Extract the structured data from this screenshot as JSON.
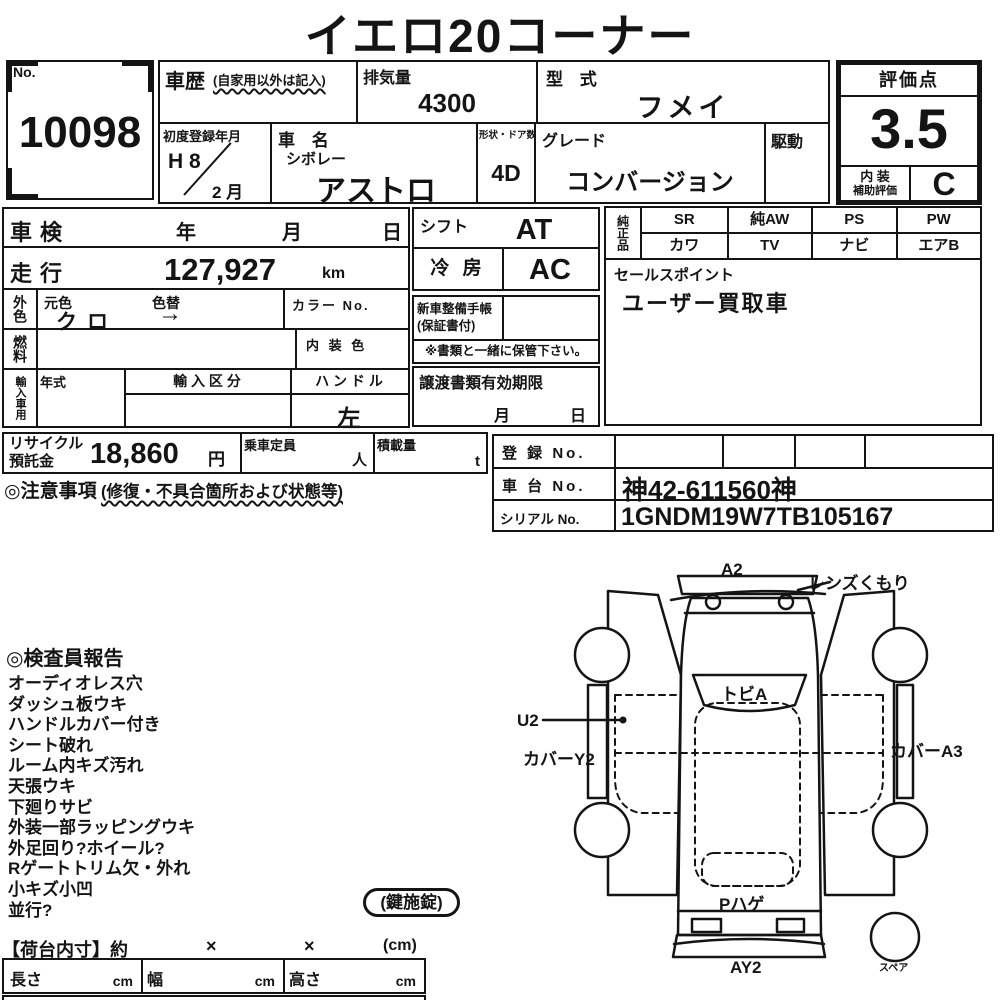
{
  "title": "イエロ20コーナー",
  "header": {
    "no_label": "No.",
    "no_value": "10098",
    "history_label": "車歴",
    "history_note": "(自家用以外は記入)",
    "displacement_label": "排気量",
    "displacement_value": "4300",
    "model_code_label": "型 式",
    "model_code_value": "フメイ",
    "first_reg_label": "初度登録年月",
    "first_reg_year": "H 8",
    "first_reg_month": "2 月",
    "car_name_label": "車 名",
    "car_maker": "シボレー",
    "car_model": "アストロ",
    "shape_doors_label": "形状・ドア数",
    "shape_doors_value": "4D",
    "grade_label": "グレード",
    "grade_value": "コンバージョン",
    "drive_label": "駆動",
    "score_label": "評価点",
    "score_value": "3.5",
    "interior_label_line1": "内 装",
    "interior_label_line2": "補助評価",
    "interior_grade": "C"
  },
  "inspection": {
    "shaken_label": "車検",
    "year": "年",
    "month": "月",
    "day": "日",
    "mileage_label": "走行",
    "mileage_value": "127,927",
    "mileage_unit": "km",
    "ext_color_label": "外色",
    "orig_color_label": "元色",
    "orig_color_value": "クロ",
    "color_change_label": "色替",
    "color_change_value": "→",
    "color_no_label": "カラー No.",
    "fuel_label": "燃料",
    "interior_color_label": "内 装 色",
    "import_label": "輸入車用",
    "year_model_label": "年式",
    "import_class_label": "輸 入 区 分",
    "handle_label": "ハ ン ド ル",
    "handle_value": "左",
    "shift_label": "シフト",
    "shift_value": "AT",
    "ac_label": "冷 房",
    "ac_value": "AC",
    "service_book_line1": "新車整備手帳",
    "service_book_line2": "(保証書付)",
    "service_note": "※書類と一緒に保管下さい。",
    "transfer_label": "譲渡書類有効期限",
    "transfer_month": "月",
    "transfer_day": "日",
    "oem_label": "純正品",
    "oem_grid": [
      [
        "SR",
        "カワ"
      ],
      [
        "純AW",
        "TV"
      ],
      [
        "PS",
        "ナビ"
      ],
      [
        "PW",
        "エアB"
      ]
    ],
    "sales_point_label": "セールスポイント",
    "sales_point_value": "ユーザー買取車"
  },
  "fees": {
    "recycle_label_line1": "リサイクル",
    "recycle_label_line2": "預託金",
    "recycle_value": "18,860",
    "recycle_unit": "円",
    "capacity_label": "乗車定員",
    "capacity_unit": "人",
    "load_label": "積載量",
    "load_unit": "t",
    "caution_label": "◎注意事項",
    "caution_note": "(修復・不具合箇所および状態等)"
  },
  "registration": {
    "reg_no_label": "登 録 No.",
    "chassis_no_label": "車 台 No.",
    "chassis_no_value": "神42-611560神",
    "serial_no_label": "シリアル No.",
    "serial_no_value": "1GNDM19W7TB105167"
  },
  "inspector_report": {
    "heading": "◎検査員報告",
    "items": [
      "オーディオレス穴",
      "ダッシュ板ウキ",
      "ハンドルカバー付き",
      "シート破れ",
      "ルーム内キズ汚れ",
      "天張ウキ",
      "下廻りサビ",
      "外装一部ラッピングウキ",
      "外足回り?ホイール?",
      "Rゲートトリム欠・外れ",
      "小キズ小凹",
      "並行?"
    ],
    "key_lock": "(鍵施錠)"
  },
  "cargo": {
    "heading": "【荷台内寸】約",
    "x1": "×",
    "x2": "×",
    "unit": "(cm)",
    "length_label": "長さ",
    "width_label": "幅",
    "height_label": "高さ",
    "cm": "cm"
  },
  "diagram": {
    "label_a2": "A2",
    "label_lens": "レンズくもり",
    "label_tobi": "トビA",
    "label_u2": "U2",
    "label_cover_y2": "カバーY2",
    "label_cover_a3": "カバーA3",
    "label_p_hage": "Pハゲ",
    "label_ay2": "AY2",
    "label_spare": "スペア"
  }
}
